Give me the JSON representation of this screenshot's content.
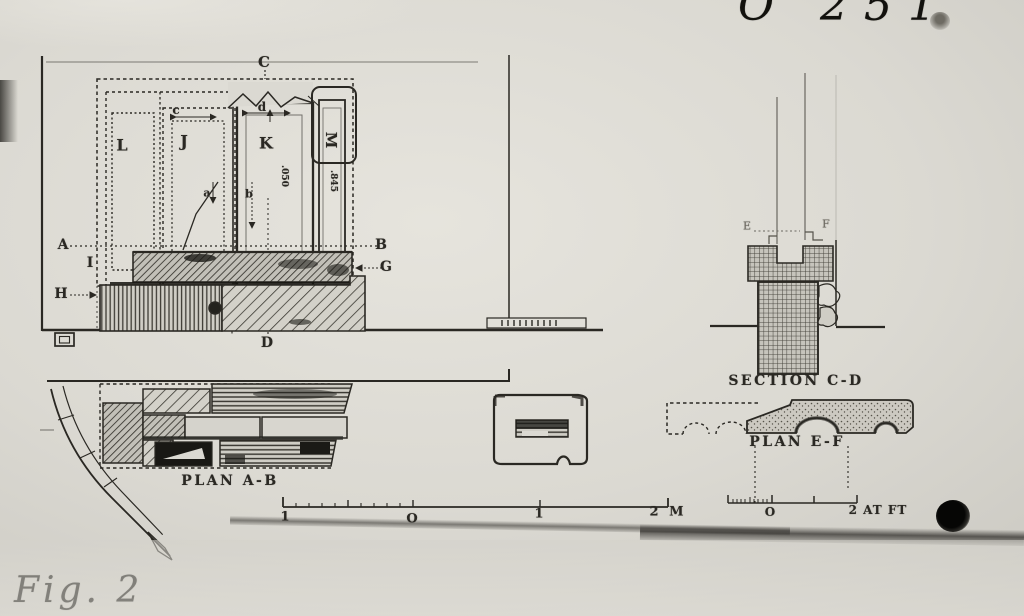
{
  "colors": {
    "paper": "#dbd9d2",
    "paper_light": "#e6e4dd",
    "paper_dark": "#c5c3bc",
    "ink": "#2a2823",
    "ink_soft": "#56534b"
  },
  "handwriting": {
    "catalog_number": "O 251",
    "figure_caption": "Fig. 2"
  },
  "elevation": {
    "section_line_top": "C",
    "section_line_bottom": "D",
    "block_l": "L",
    "block_j": "J",
    "block_k": "K",
    "block_m": "M",
    "dim_c": "c",
    "dim_d": "d",
    "dim_a": "a",
    "dim_b": "b",
    "level_left": "A",
    "level_right": "B",
    "label_i": "I",
    "label_g": "G",
    "label_h": "H",
    "measure_k": ".050",
    "measure_m": ".845"
  },
  "plan_ab": {
    "caption": "PLAN A-B"
  },
  "section_cd": {
    "caption": "SECTION C-D",
    "label_e": "E",
    "label_f": "F"
  },
  "plan_ef": {
    "caption": "PLAN E-F"
  },
  "scale_meters": {
    "tick_labels": [
      "1",
      "O",
      "1",
      "2 M"
    ]
  },
  "scale_feet": {
    "tick_labels": [
      "O",
      "2 AT FT"
    ]
  }
}
